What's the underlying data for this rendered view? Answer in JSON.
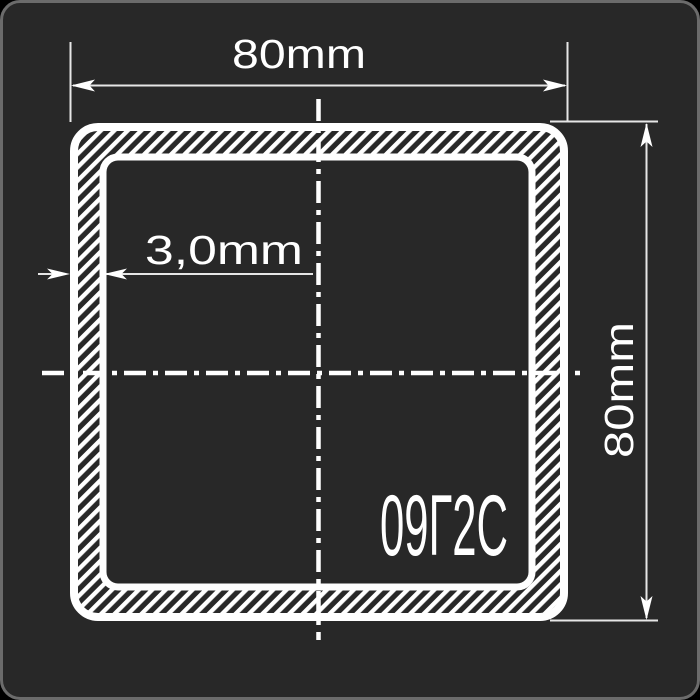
{
  "page": {
    "background_color": "#282828",
    "frame_border_color": "#6b6b6b",
    "line_color": "#ffffff",
    "thin_line_color": "#e6e6e6"
  },
  "drawing": {
    "width_label": "80mm",
    "height_label": "80mm",
    "wall_thickness_label": "3,0mm",
    "steel_grade": "09Г2С"
  }
}
